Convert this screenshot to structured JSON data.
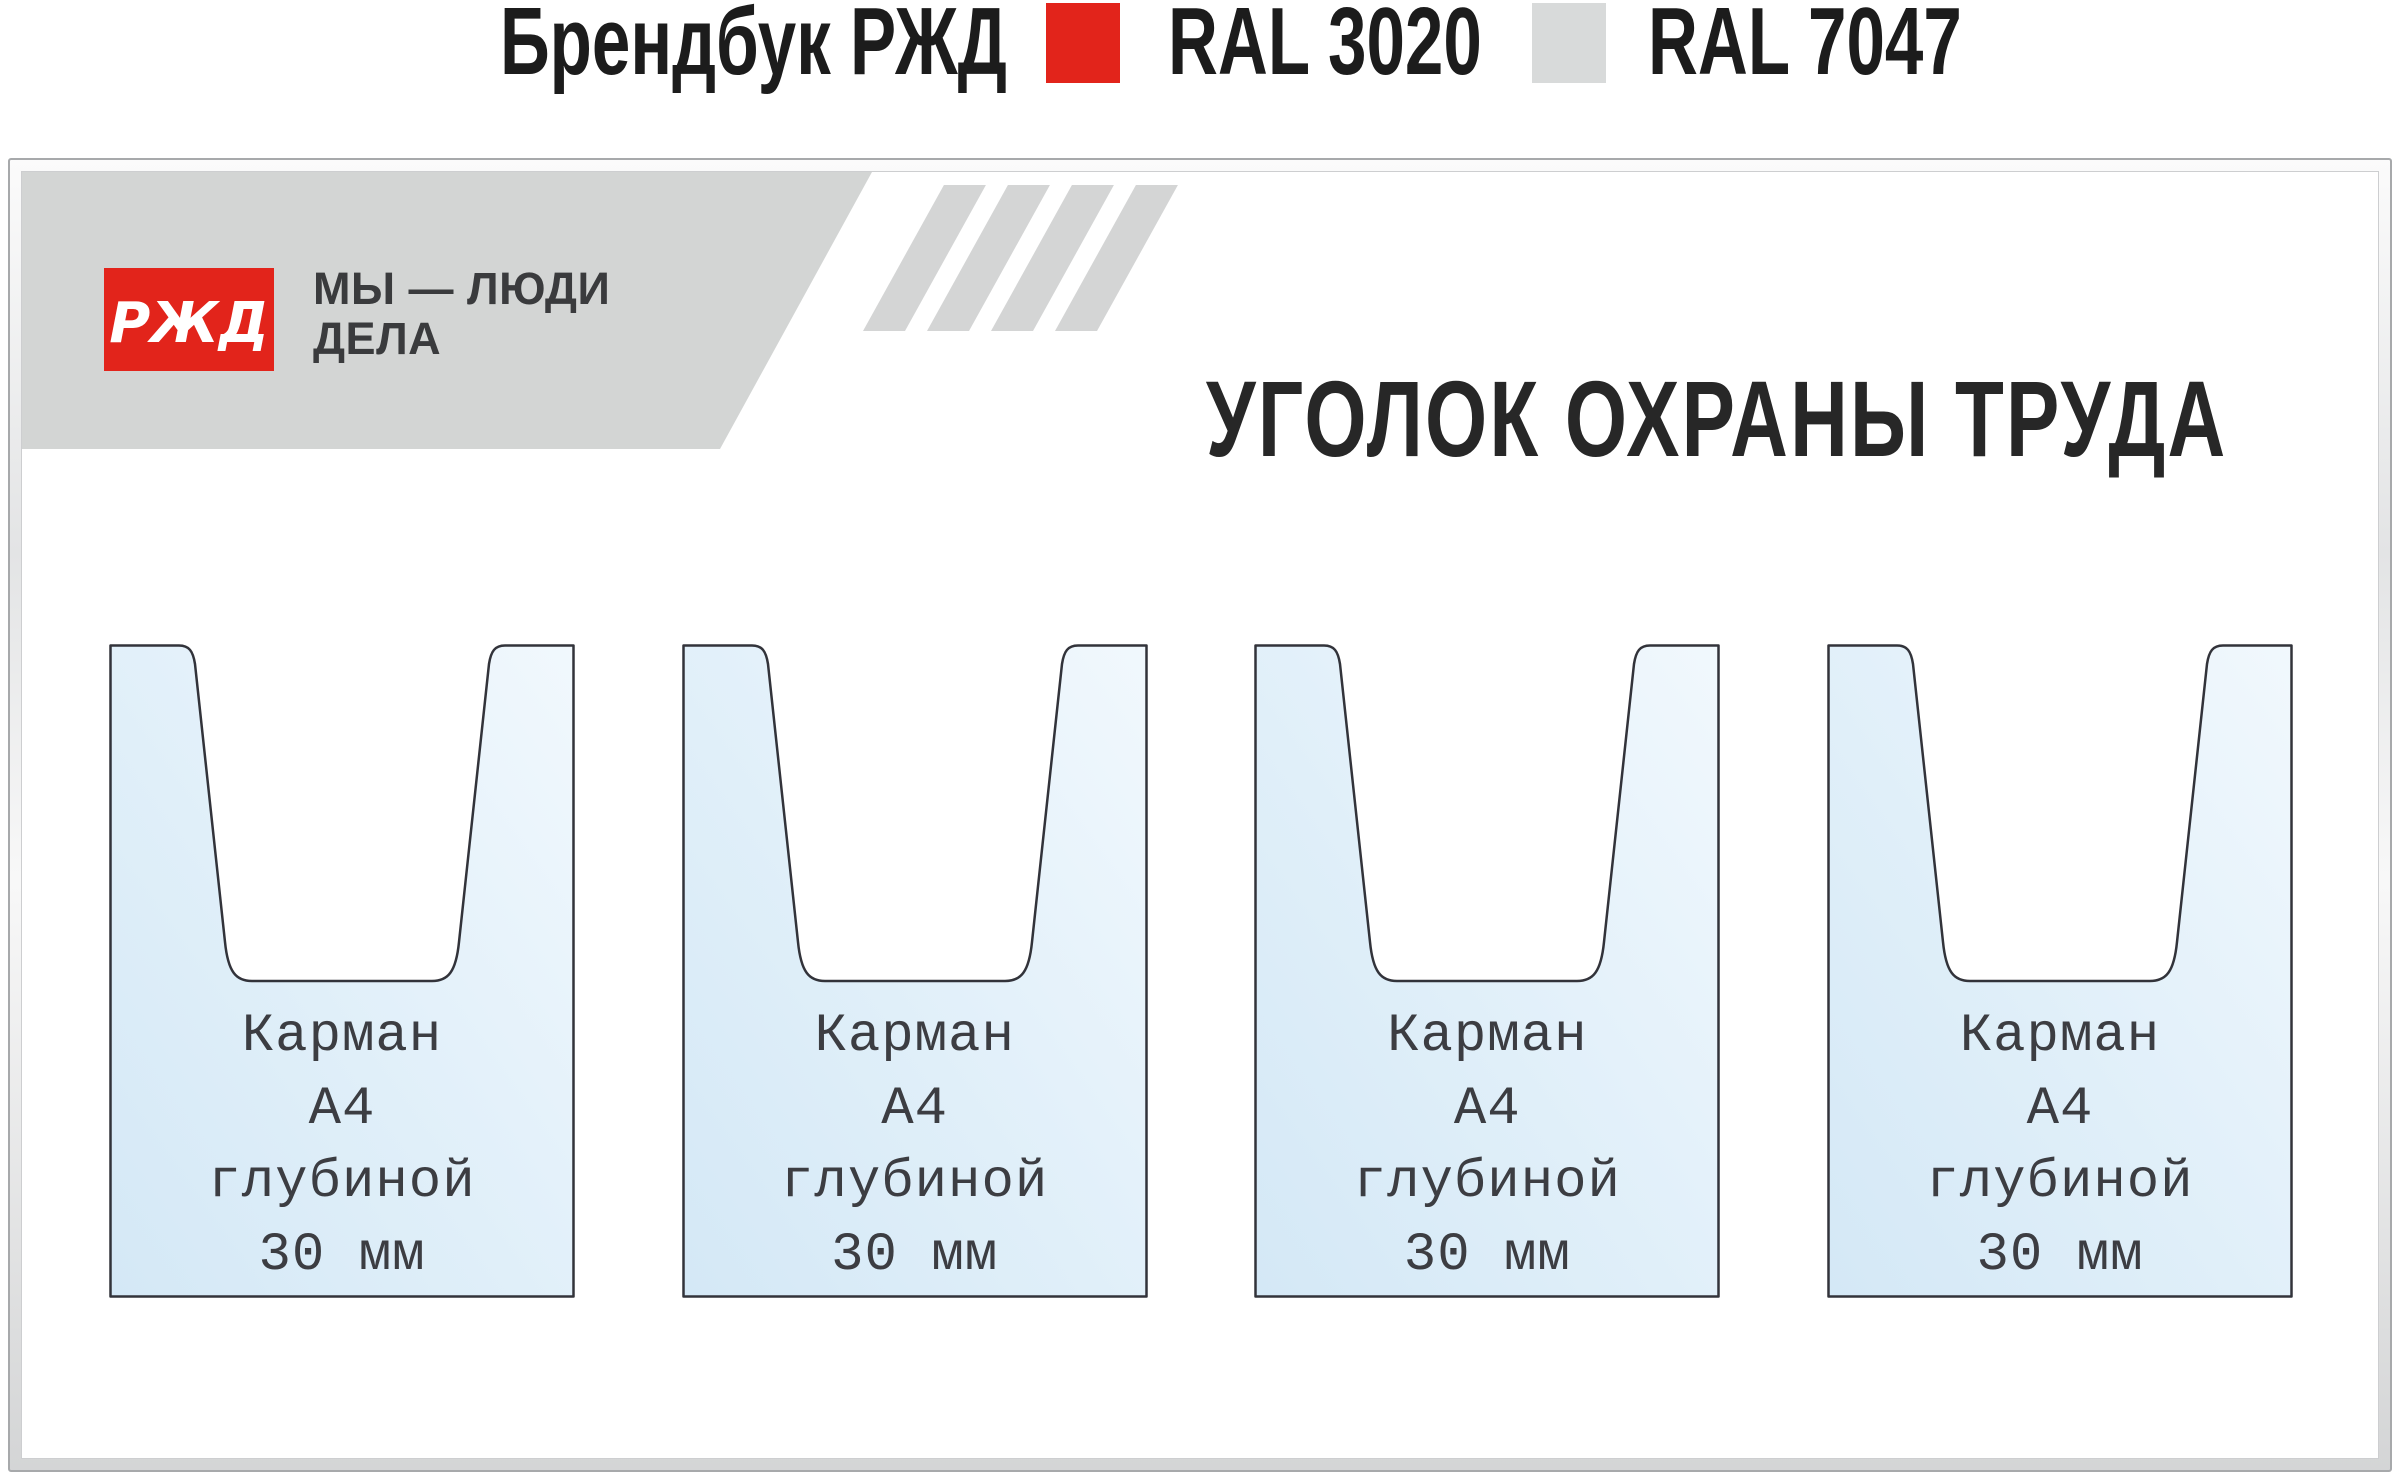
{
  "header": {
    "brandbook_label": "Брендбук РЖД",
    "swatches": [
      {
        "name": "RAL 3020",
        "color": "#e2241b"
      },
      {
        "name": "RAL 7047",
        "color": "#d8dada"
      }
    ]
  },
  "board": {
    "logo_text": "РЖД",
    "slogan_line1": "МЫ — ЛЮДИ",
    "slogan_line2": "ДЕЛА",
    "title": "УГОЛОК ОХРАНЫ ТРУДА",
    "colors": {
      "band_gray": "#d3d5d4",
      "stripe_gray": "#d4d5d5",
      "logo_red": "#e2241b",
      "frame_gray": "#a7a9ab",
      "pocket_fill_light": "#f1f8fd",
      "pocket_fill_dark": "#d4e8f6",
      "pocket_outline": "#32333a"
    },
    "pockets": [
      {
        "lines": [
          "Карман",
          "А4",
          "глубиной",
          "30 мм"
        ]
      },
      {
        "lines": [
          "Карман",
          "А4",
          "глубиной",
          "30 мм"
        ]
      },
      {
        "lines": [
          "Карман",
          "А4",
          "глубиной",
          "30 мм"
        ]
      },
      {
        "lines": [
          "Карман",
          "А4",
          "глубиной",
          "30 мм"
        ]
      }
    ]
  }
}
